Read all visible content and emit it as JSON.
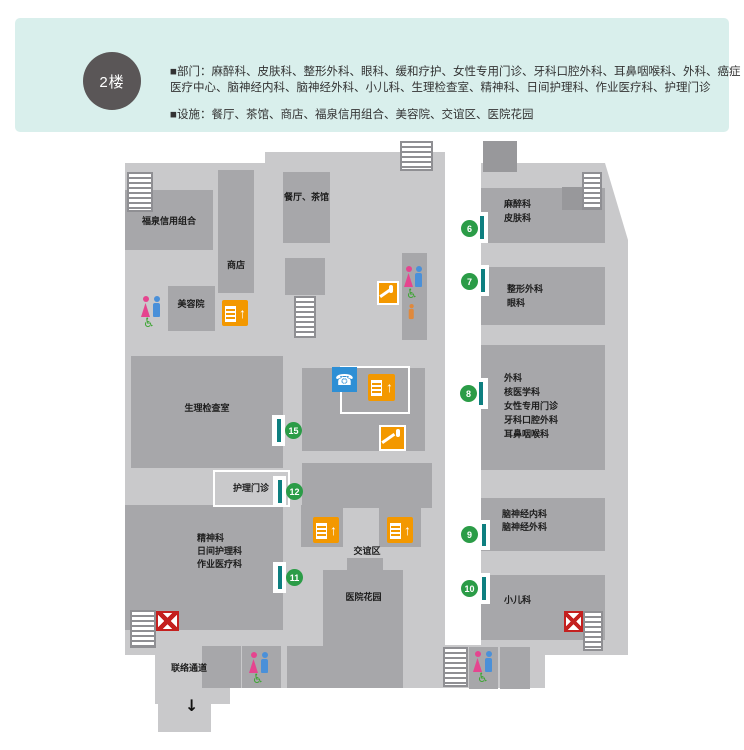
{
  "header": {
    "floor_badge": "2楼",
    "departments": "■部门：麻醉科、皮肤科、整形外科、眼科、缓和疗护、女性专用门诊、牙科口腔外科、耳鼻咽喉科、外科、癌症医疗中心、脑神经内科、脑神经外科、小儿科、生理检查室、精神科、日间护理科、作业医疗科、护理门诊",
    "facilities": "■设施：餐厅、茶馆、商店、福泉信用组合、美容院、交谊区、医院花园"
  },
  "map": {
    "rooms": {
      "fukusen_credit_union": "福泉信用组合",
      "shop": "商店",
      "restaurant_teahouse": "餐厅、茶馆",
      "beauty_salon": "美容院",
      "physiology_exam_room": "生理检查室",
      "nursing_clinic": "护理门诊",
      "psychiatry_block": "精神科\n日间护理科\n作业医疗科",
      "anesthesia_block": "麻醉科\n皮肤科",
      "plastic_surgery_block": "整形外科\n眼科",
      "surgery_block": "外科\n核医学科\n女性专用门诊\n牙科口腔外科\n耳鼻咽喉科",
      "neurology_block": "脑神经内科\n脑神经外科",
      "pediatrics": "小儿科",
      "social_area": "交谊区",
      "hospital_garden": "医院花园",
      "connecting_passage": "联络通道"
    },
    "windows": {
      "w6": "6",
      "w7": "7",
      "w8": "8",
      "w9": "9",
      "w10": "10",
      "w11": "11",
      "w12": "12",
      "w15": "15"
    },
    "glyphs": {
      "phone": "☎",
      "up_arrow": "↑",
      "down_arrow": "↓",
      "wheelchair": "♿"
    }
  },
  "colors": {
    "header_bg": "#d9efec",
    "badge_bg": "#5a5657",
    "floor_light": "#c9c9cb",
    "room_dark": "#a7a7aa",
    "accent_orange": "#f39800",
    "phone_blue": "#2e8fd5",
    "window_green": "#2b9c47",
    "window_teal": "#0e7f80",
    "female_pink": "#e5458f",
    "male_blue": "#4a90d9",
    "wheelchair_green": "#3fa535",
    "exit_red": "#c4201f"
  }
}
